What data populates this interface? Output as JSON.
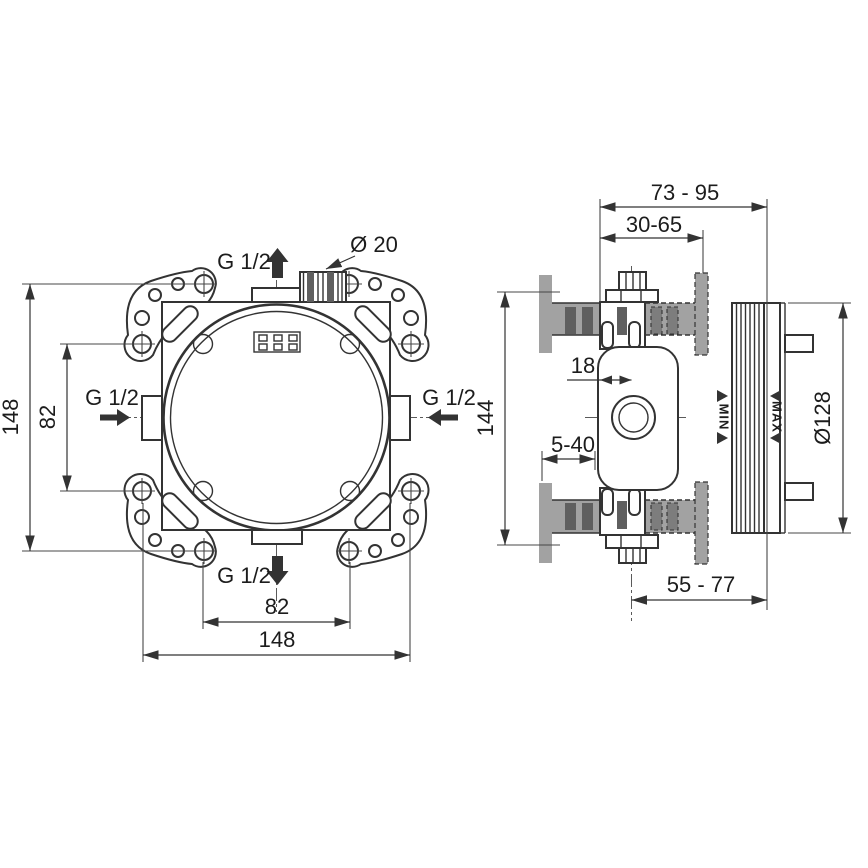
{
  "colors": {
    "line": "#333333",
    "wall_gray": "#a2a2a2",
    "slot_dark_gray": "#5f5f5f",
    "background": "#ffffff"
  },
  "front_view": {
    "dim_height_overall": "148",
    "dim_height_fixing": "82",
    "dim_width_fixing": "82",
    "dim_width_overall": "148",
    "connection_top": "G 1/2",
    "connection_left": "G 1/2",
    "connection_right": "G 1/2",
    "connection_bottom": "G 1/2",
    "conduit_diameter": "Ø 20"
  },
  "side_view": {
    "dim_depth_overall": "73 - 95",
    "dim_box_depth": "30-65",
    "dim_center_offset": "18",
    "dim_plaster_range": "5-40",
    "dim_height": "144",
    "dim_faceplate_diameter": "Ø128",
    "dim_cover_depth": "55 - 77",
    "marker_min": "MIN",
    "marker_max": "MAX"
  }
}
